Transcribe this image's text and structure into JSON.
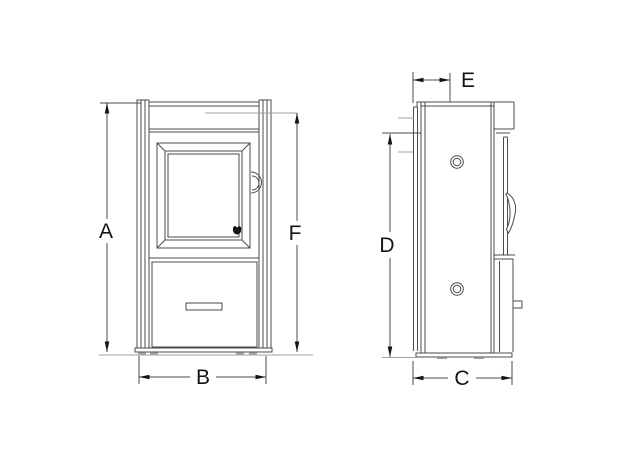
{
  "diagram": {
    "labels": {
      "A": "A",
      "B": "B",
      "C": "C",
      "D": "D",
      "E": "E",
      "F": "F"
    },
    "colors": {
      "line": "#4b4b4b",
      "extension": "#9aa0a3",
      "label": "#141414",
      "background": "#ffffff"
    }
  }
}
